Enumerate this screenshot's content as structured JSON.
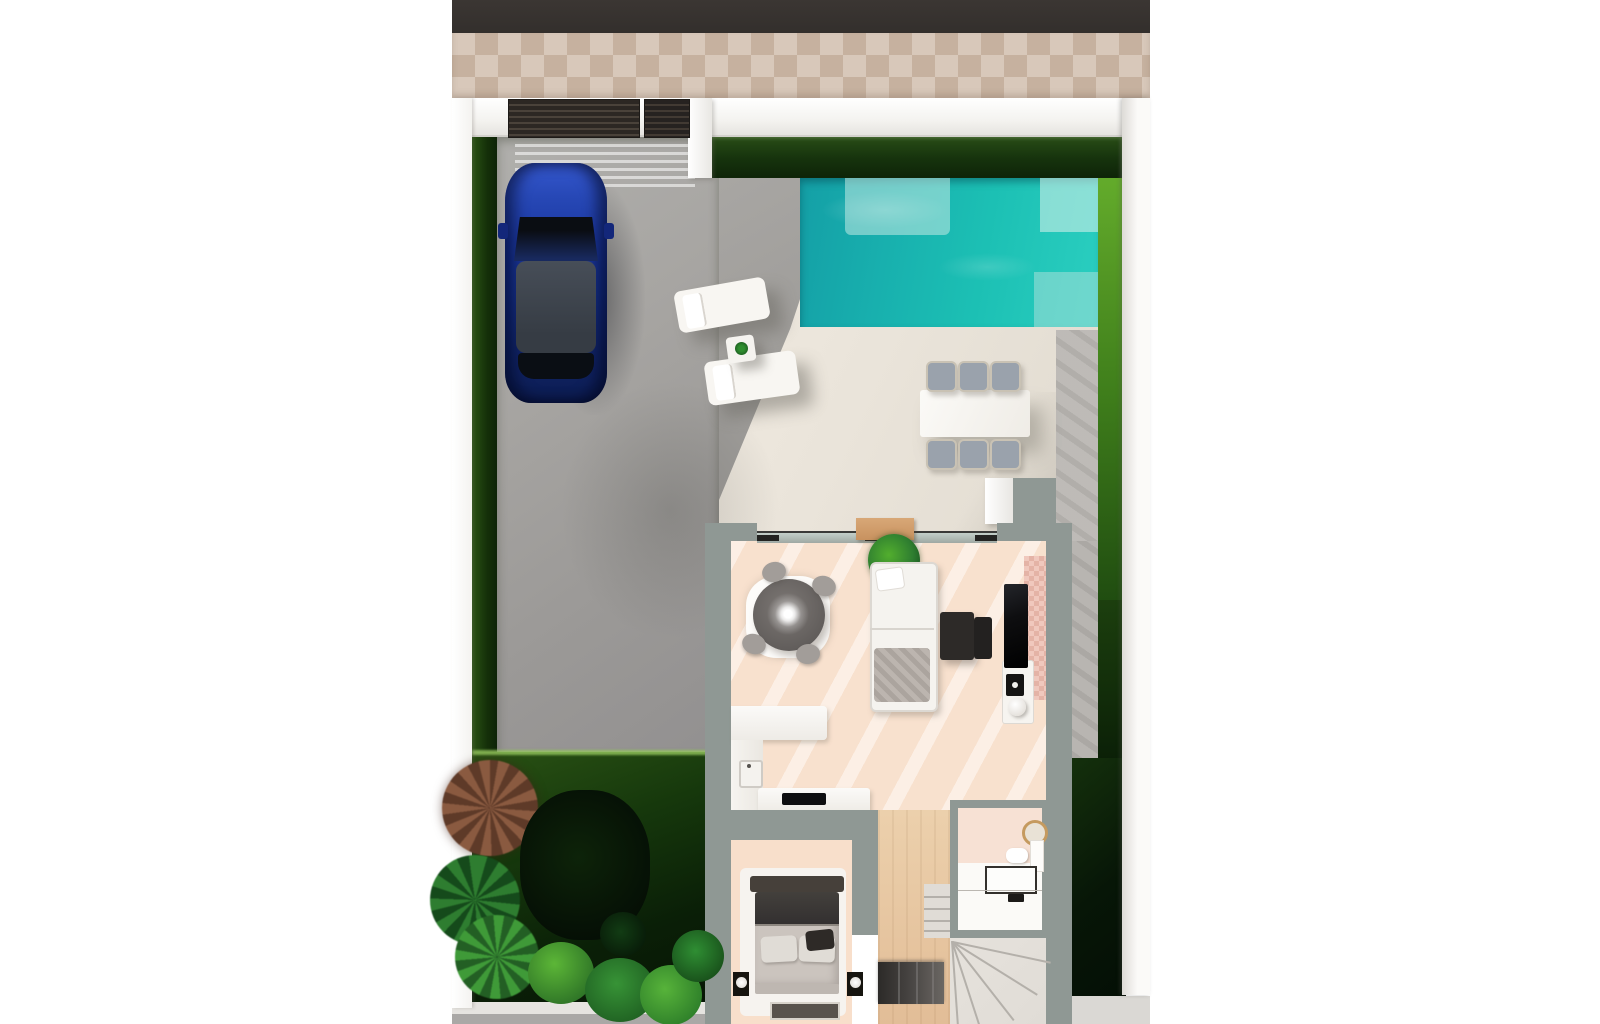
{
  "meta": {
    "type": "3d-floorplan-render",
    "description": "Top-down 3D architectural render of a villa ground floor: street and tiled sidewalk at top, walled plot with entrance gate, gray paved driveway with a parked blue SUV, turquoise swimming pool with steps, cream terrace with two sun loungers, side table and a six-chair outdoor dining set, lawns and hedges around the plot, dense garden planting in the lower-left corner, and the house interior showing an open-plan living room (round dark table with light sparkle, L-shaped sofa, nesting coffee tables, TV wall with pink tile accent, houseplant), an L-shaped kitchen with island hob, a bedroom with double bed, nightstands and lamps, a bathroom with round gold mirror, toilet, vanity and shower, plus a winder staircase."
  },
  "colors": {
    "road": "#3b3633",
    "walk1": "#d8c8ba",
    "walk2": "#c6b19f",
    "wallw": "#f4f3f0",
    "wall-shade": "#dddbd7",
    "gate": "#2c2723",
    "gate-slat": "#4a423a",
    "hedge1": "#2a4f17",
    "hedge2": "#0e2408",
    "lawnb1": "#63ab2b",
    "lawnb2": "#1f4b10",
    "drive": "#a7a5a2",
    "stone": "#bab7b3",
    "terr": "#eae4da",
    "pool1": "#149fa6",
    "pool2": "#1cc0b4",
    "pool3": "#2bcfc0",
    "carb1": "#15308c",
    "carb2": "#0c1c50",
    "carroof": "#363c44",
    "chair": "#9aa2ac",
    "iwall": "#8f9894",
    "floorp": "#f8dfcb",
    "wood": "#e2bd97",
    "whitef": "#f5f3ef",
    "grayf": "#a29d99",
    "darkf": "#2d2a28",
    "tv": "#0e0e10",
    "tilep": "#f0c8bd",
    "tilep2": "#e4b3a6",
    "gold": "#c59a5f",
    "plant1": "#2e7d30",
    "plant2": "#154a1b",
    "plant3": "#52ae2e",
    "mat": "#c8925f",
    "bedhead": "#46403a",
    "blanket": "#333030",
    "matt": "#cbc4be",
    "pillow": "#e0dcd6",
    "stairl": "#e0dcd6",
    "stairline": "#b4b0aa",
    "stairdk": "#2c2a28",
    "bath": "#f7e1d4"
  },
  "scene": {
    "items": [
      "street-road",
      "sidewalk-tiles",
      "perimeter-wall",
      "entrance-gate",
      "driveway",
      "car",
      "hedges",
      "swimming-pool",
      "pool-steps",
      "terrace",
      "sun-loungers",
      "lounger-side-table",
      "outdoor-dining-set",
      "lawns",
      "garden-plants",
      "living-room",
      "round-dining-table",
      "sofa",
      "coffee-tables",
      "tv-unit",
      "houseplant",
      "kitchen",
      "bedroom",
      "bed",
      "nightstands",
      "bathroom",
      "staircase",
      "hallway"
    ]
  }
}
